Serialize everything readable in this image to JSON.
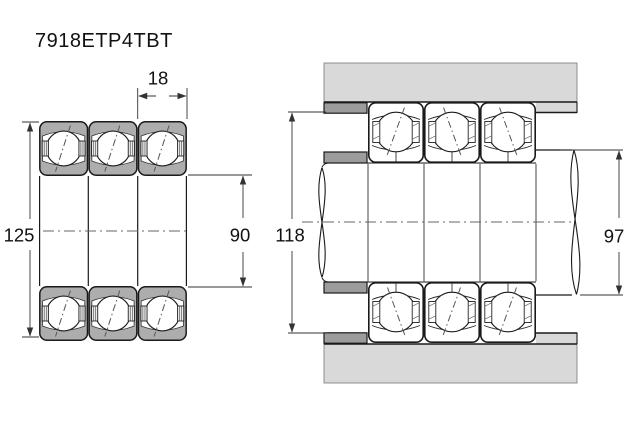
{
  "title": "7918ETP4TBT",
  "front_view": {
    "width_label": "18",
    "outer_diameter_label": "125",
    "bore_diameter_label": "90"
  },
  "mounted_view": {
    "housing_abutment_label": "118",
    "shaft_abutment_label": "97"
  },
  "colors": {
    "bearing_ring_fill": "#adadad",
    "housing_fill": "#d9d9d9",
    "spacer_fill": "#9c9c9c",
    "line": "#1a1a1a",
    "dim_line": "#333333"
  }
}
